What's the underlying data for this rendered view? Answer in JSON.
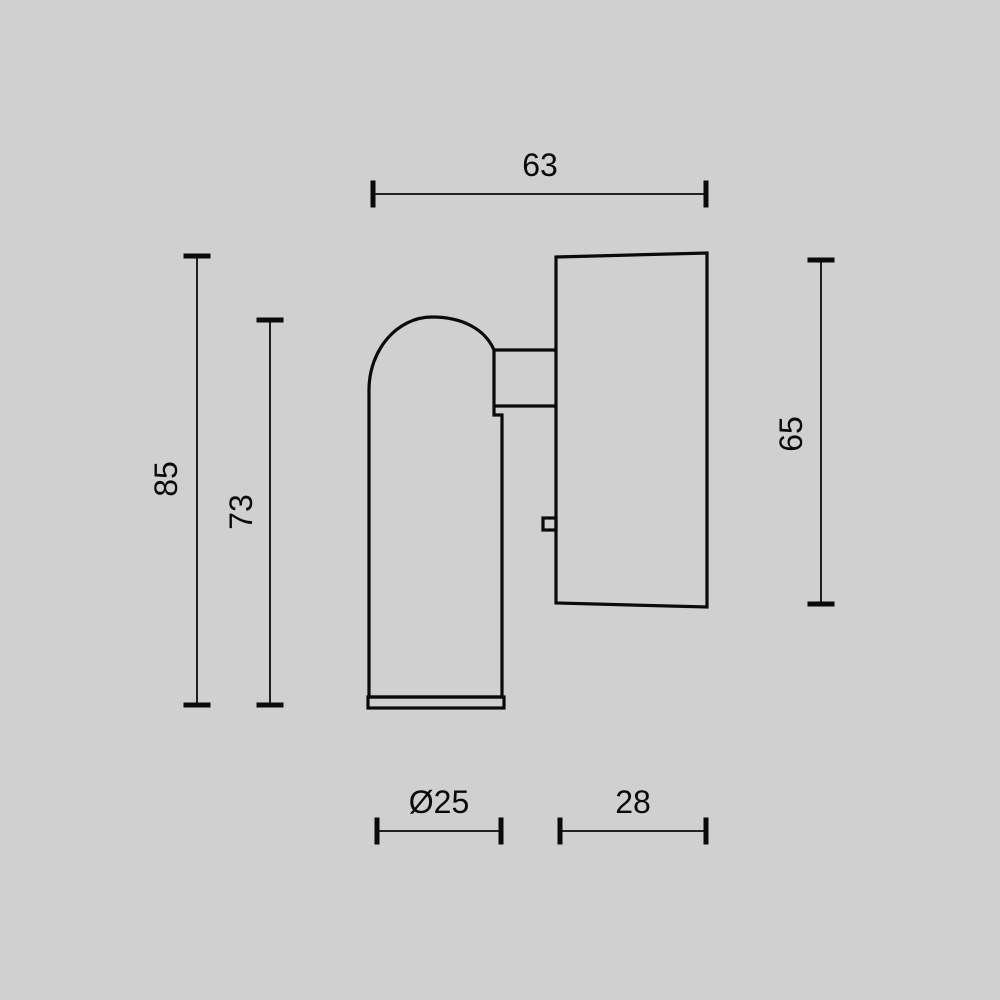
{
  "colors": {
    "background": "#d0d0d0",
    "line": "#0a0a0a"
  },
  "dimensions": {
    "fixture_width": "63",
    "overall_height": "85",
    "head_height": "73",
    "mount_height": "65",
    "head_diameter": "Ø25",
    "mount_width": "28"
  }
}
